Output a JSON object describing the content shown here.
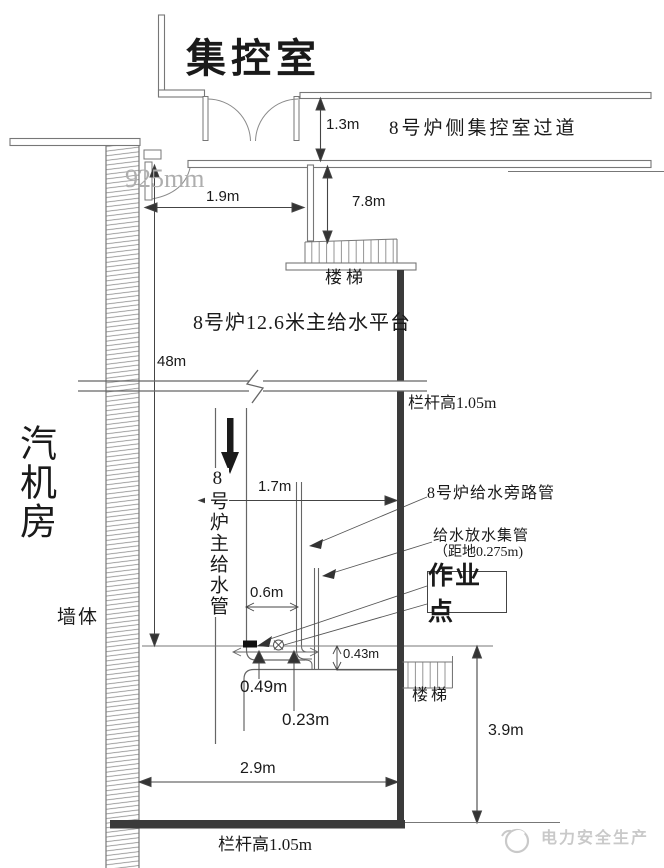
{
  "labels": {
    "control_room": "集控室",
    "corridor": "8号炉侧集控室过道",
    "turbine_hall": "汽机房",
    "wall": "墙体",
    "platform": "8号炉12.6米主给水平台",
    "stairs_upper": "楼梯",
    "stairs_lower": "楼梯",
    "main_feedwater_pipe": "8号炉主给水管",
    "bypass_pipe": "8号炉给水旁路管",
    "drain_header": "给水放水集管",
    "drain_header_note": "（距地0.275m)",
    "work_point": "作业点",
    "railing_upper": "栏杆高1.05m",
    "railing_lower": "栏杆高1.05m",
    "watermark": "电力安全生产"
  },
  "dimensions": {
    "door_drop": "1.3m",
    "gray_width": "925mm",
    "corridor_width": "1.9m",
    "stair_drop": "7.8m",
    "platform_elevation": "48m",
    "pipe_to_railing": "1.7m",
    "pipe_spacing": "0.6m",
    "header_height": "0.43m",
    "offset_a": "0.49m",
    "offset_b": "0.23m",
    "floor_height": "3.9m",
    "floor_width": "2.9m"
  },
  "colors": {
    "thin_line": "#6b6b6b",
    "dim_line": "#444444",
    "thick_bar": "#3a3a3a",
    "text": "#1a1a1a",
    "gray_watermark": "#aeaeae",
    "logo_gray": "#c9c9c9"
  }
}
